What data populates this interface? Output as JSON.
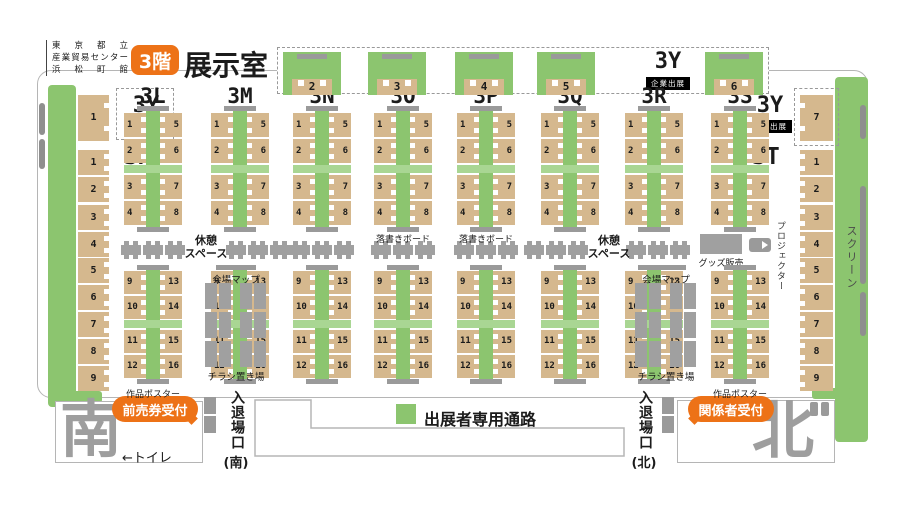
{
  "title_block": {
    "venue_lines": [
      "東京都立",
      "産業貿易センター",
      "浜松町館"
    ],
    "floor_badge": "3階",
    "page_title": "展示室"
  },
  "top_row": {
    "zone_label": "3Y",
    "zone_sub": "企業出展",
    "booths": [
      "2",
      "3",
      "4",
      "5",
      "6"
    ]
  },
  "columns": {
    "ids": [
      "3L",
      "3M",
      "3N",
      "3O",
      "3P",
      "3Q",
      "3R",
      "3S"
    ],
    "upper_left": [
      "1",
      "2",
      "3",
      "4"
    ],
    "upper_right": [
      "5",
      "6",
      "7",
      "8"
    ],
    "lower_left": [
      "9",
      "10",
      "11",
      "12"
    ],
    "lower_right": [
      "13",
      "14",
      "15",
      "16"
    ]
  },
  "left_wing": {
    "zone_label": "3Y",
    "zone_sub": "企業出展",
    "zone_booth": "1",
    "section_label": "3K",
    "booths": [
      "1",
      "2",
      "3",
      "4",
      "5",
      "6",
      "7",
      "8",
      "9"
    ]
  },
  "right_wing": {
    "zone_label": "3Y",
    "zone_sub": "企業出展",
    "zone_booth": "7",
    "section_label": "3T",
    "booths": [
      "1",
      "2",
      "3",
      "4",
      "5",
      "6",
      "7",
      "8",
      "9"
    ],
    "screen_label": "スクリーン"
  },
  "amenities": {
    "rest_lines": [
      "休憩",
      "スペース"
    ],
    "board_label": "落書きボード",
    "map_label": "会場マップ",
    "flyer_label": "チラシ置き場",
    "goods_label": "グッズ販売",
    "projector_label": "プロジェクター",
    "poster_label": "作品ポスター"
  },
  "legend": {
    "aisle_label": "出展者専用通路"
  },
  "south": {
    "big_label": "南",
    "reception_label": "前売券受付",
    "toilet_label": "←トイレ",
    "gate_vertical": "入退場口",
    "gate_paren": "(南)"
  },
  "north": {
    "big_label": "北",
    "reception_label": "関係者受付",
    "gate_vertical": "入退場口",
    "gate_paren": "(北)"
  },
  "colors": {
    "green": "#8cc56f",
    "green_light": "#a9d693",
    "tan": "#d5b88e",
    "grey_furniture": "#a0a0a0",
    "grey_bar": "#9a9a9a",
    "orange": "#ed7217",
    "wall": "#b5b5b5",
    "big_dir": "#9e9e9e"
  }
}
